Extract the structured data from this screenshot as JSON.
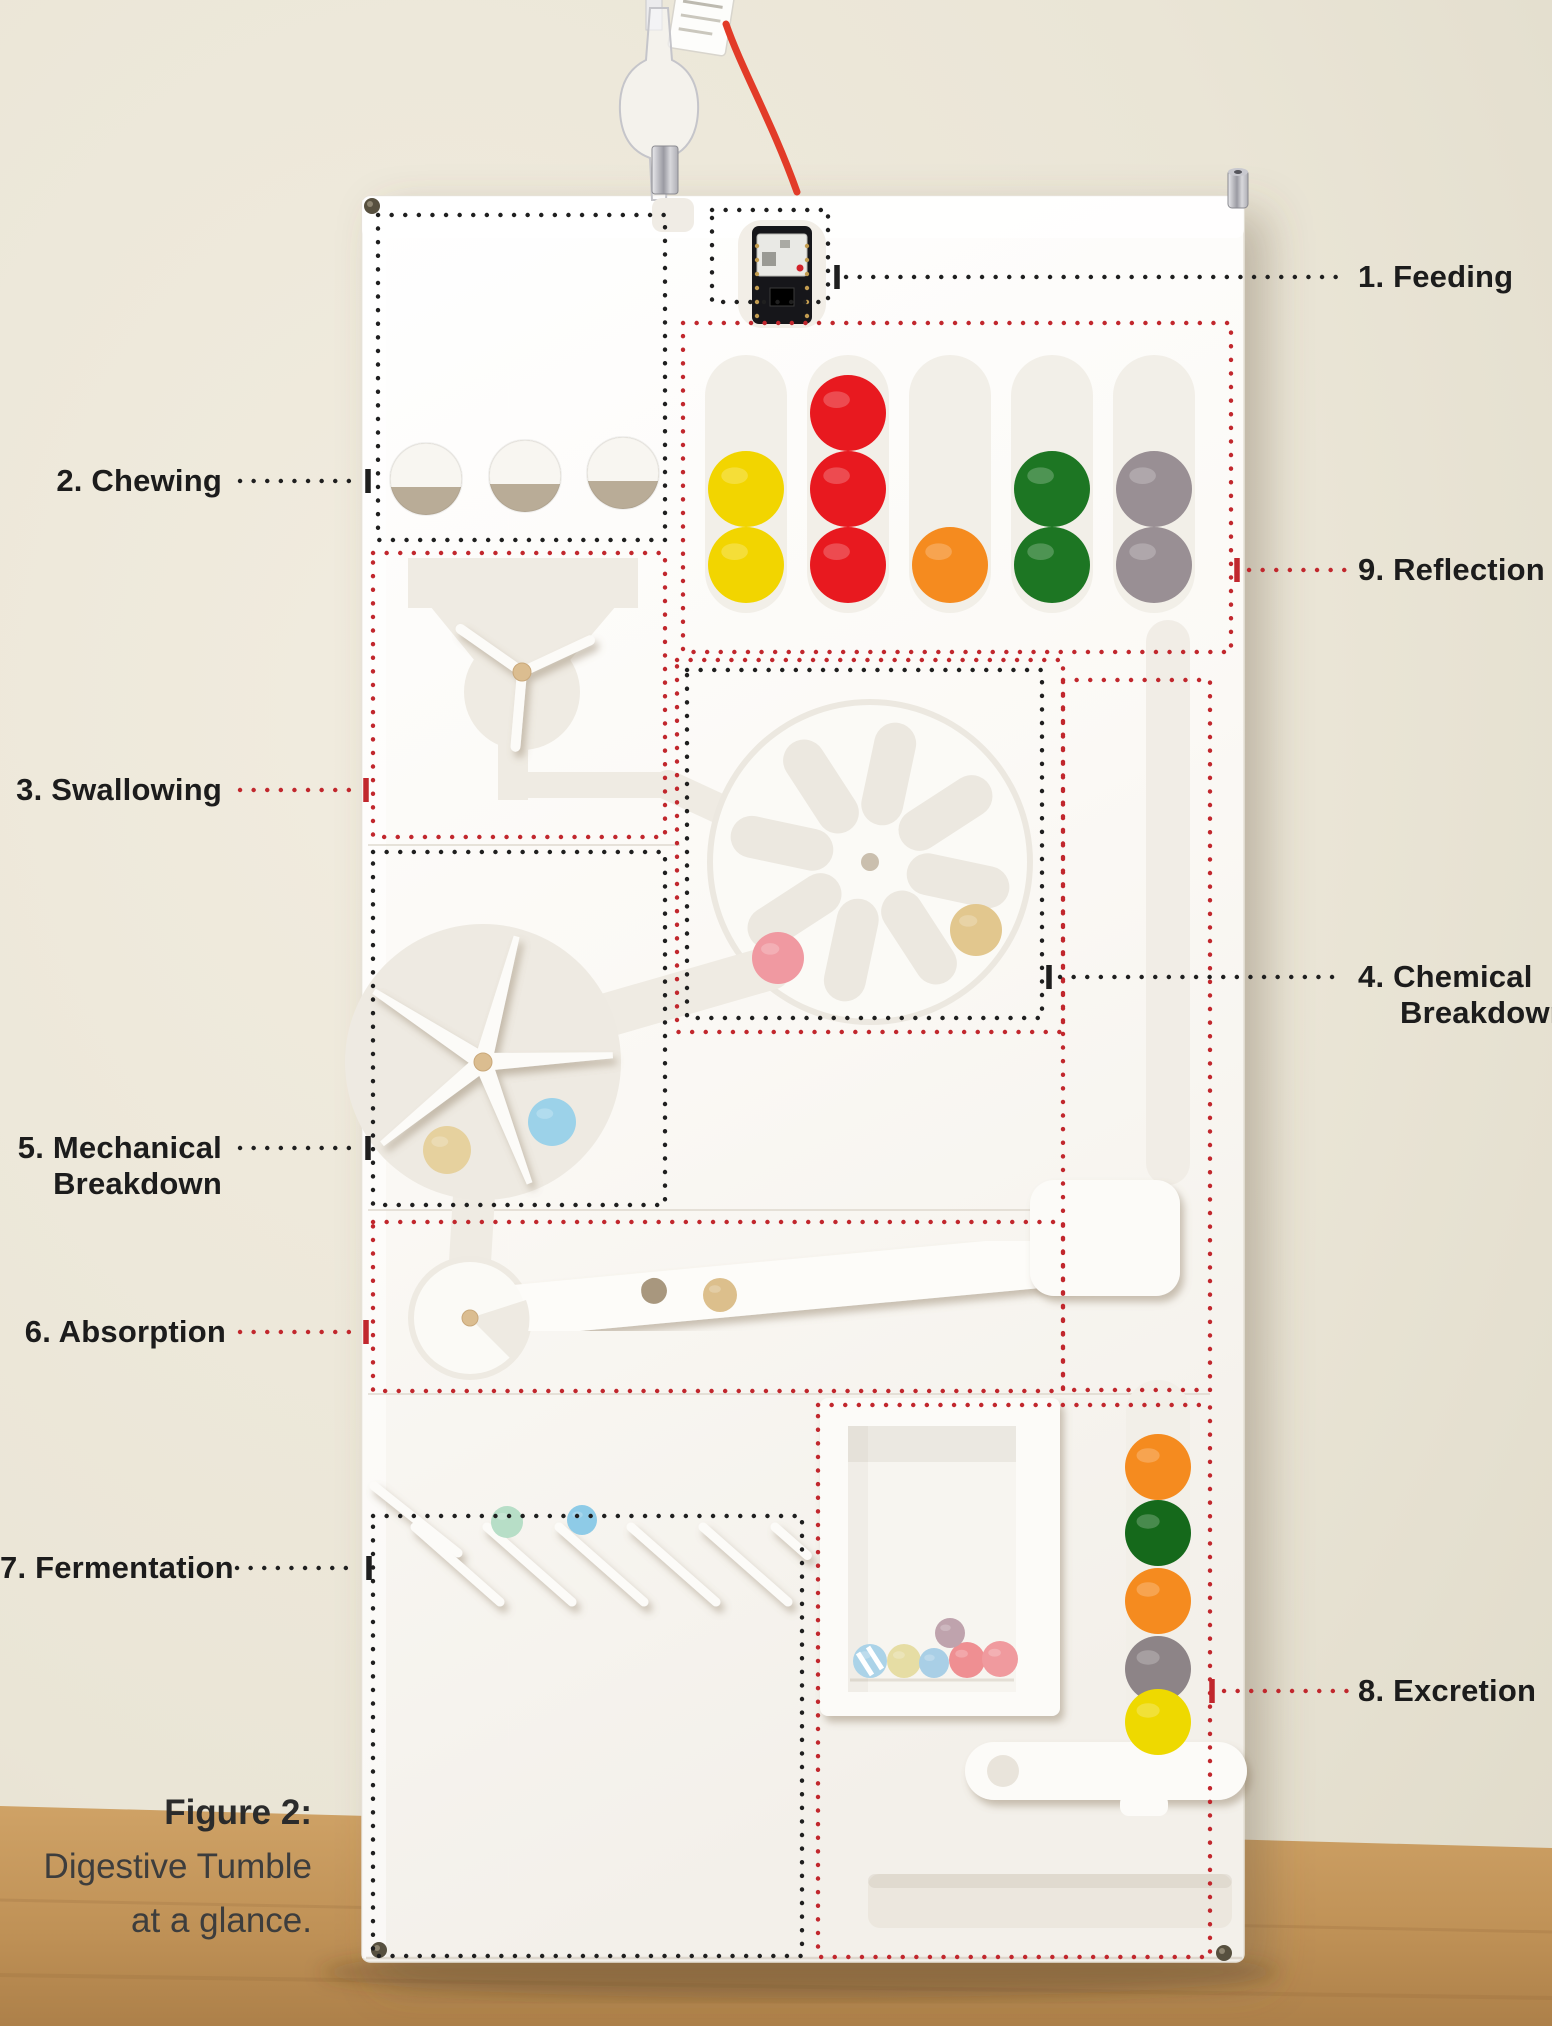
{
  "figure_caption": {
    "title": "Figure 2:",
    "line1": "Digestive Tumble",
    "line2": "at a glance."
  },
  "annotation_colors": {
    "black": "#1f1f1f",
    "red": "#c1272d"
  },
  "annotations": [
    {
      "id": "feeding",
      "label": "1. Feeding",
      "color": "black",
      "box": {
        "x": 712,
        "y": 210,
        "w": 116,
        "h": 92
      },
      "leader": {
        "x1": 846,
        "x2": 1340,
        "y": 277
      },
      "tick": {
        "x": 837,
        "y": 277
      }
    },
    {
      "id": "chewing",
      "label": "2. Chewing",
      "color": "black",
      "box": {
        "x": 378,
        "y": 215,
        "w": 287,
        "h": 325
      },
      "leader": {
        "x1": 240,
        "x2": 358,
        "y": 481
      },
      "tick": {
        "x": 368,
        "y": 481
      }
    },
    {
      "id": "swallowing",
      "label": "3. Swallowing",
      "color": "red",
      "box": {
        "x": 373,
        "y": 553,
        "w": 292,
        "h": 284
      },
      "leader": {
        "x1": 240,
        "x2": 356,
        "y": 790
      },
      "tick": {
        "x": 366,
        "y": 790
      }
    },
    {
      "id": "chemical-breakdown",
      "label": "4. Chemical Breakdown",
      "lines": [
        "4. Chemical",
        "Breakdown"
      ],
      "color": "black",
      "box": {
        "x": 687,
        "y": 670,
        "w": 355,
        "h": 348
      },
      "leader": {
        "x1": 1060,
        "x2": 1345,
        "y": 977
      },
      "tick": {
        "x": 1049,
        "y": 977
      }
    },
    {
      "id": "mechanical-breakdown",
      "label": "5. Mechanical Breakdown",
      "lines": [
        "5. Mechanical",
        "Breakdown"
      ],
      "color": "black",
      "box": {
        "x": 373,
        "y": 852,
        "w": 292,
        "h": 353
      },
      "leader": {
        "x1": 240,
        "x2": 358,
        "y": 1148
      },
      "tick": {
        "x": 368,
        "y": 1148
      }
    },
    {
      "id": "absorption",
      "label": "6. Absorption",
      "color": "red",
      "box": {
        "x": 373,
        "y": 1222,
        "w": 690,
        "h": 169
      },
      "leader": {
        "x1": 240,
        "x2": 356,
        "y": 1332
      },
      "tick": {
        "x": 366,
        "y": 1332
      }
    },
    {
      "id": "fermentation",
      "label": "7. Fermentation",
      "color": "black",
      "box": {
        "x": 373,
        "y": 1516,
        "w": 429,
        "h": 440
      },
      "leader": {
        "x1": 237,
        "x2": 359,
        "y": 1568
      },
      "tick": {
        "x": 369,
        "y": 1568
      }
    },
    {
      "id": "excretion",
      "label": "8. Excretion",
      "color": "red",
      "box": {
        "x": 818,
        "y": 1405,
        "w": 392,
        "h": 552
      },
      "leader": {
        "x1": 1224,
        "x2": 1350,
        "y": 1691
      },
      "tick": {
        "x": 1212,
        "y": 1691
      }
    },
    {
      "id": "reflection",
      "label": "9. Reflection",
      "color": "red",
      "box": {
        "x": 683,
        "y": 323,
        "w": 548,
        "h": 329
      },
      "leader": {
        "x1": 1249,
        "x2": 1350,
        "y": 570
      },
      "tick": {
        "x": 1237,
        "y": 570
      }
    }
  ],
  "extra_boxes": [
    {
      "id": "chemical-outer-red",
      "color": "red",
      "x": 677,
      "y": 660,
      "w": 386,
      "h": 372
    },
    {
      "id": "right-channel-red",
      "color": "red",
      "x": 1063,
      "y": 680,
      "w": 147,
      "h": 710
    }
  ],
  "machine": {
    "ball_groups": [
      {
        "name": "reflection-column-yellow",
        "r": 38,
        "balls": [
          {
            "cx": 746,
            "cy": 489,
            "hex": "#f2d500"
          },
          {
            "cx": 746,
            "cy": 565,
            "hex": "#f2d500"
          }
        ]
      },
      {
        "name": "reflection-column-red",
        "r": 38,
        "balls": [
          {
            "cx": 848,
            "cy": 413,
            "hex": "#e8191f"
          },
          {
            "cx": 848,
            "cy": 489,
            "hex": "#e8191f"
          },
          {
            "cx": 848,
            "cy": 565,
            "hex": "#e8191f"
          }
        ]
      },
      {
        "name": "reflection-column-orange",
        "r": 38,
        "balls": [
          {
            "cx": 950,
            "cy": 565,
            "hex": "#f58b1f"
          }
        ]
      },
      {
        "name": "reflection-column-green",
        "r": 38,
        "balls": [
          {
            "cx": 1052,
            "cy": 489,
            "hex": "#1d7623"
          },
          {
            "cx": 1052,
            "cy": 565,
            "hex": "#1d7623"
          }
        ]
      },
      {
        "name": "reflection-column-gray",
        "r": 38,
        "balls": [
          {
            "cx": 1154,
            "cy": 489,
            "hex": "#998f94"
          },
          {
            "cx": 1154,
            "cy": 565,
            "hex": "#998f94"
          }
        ]
      },
      {
        "name": "chemical-wheel-balls",
        "r": 26,
        "balls": [
          {
            "cx": 778,
            "cy": 958,
            "hex": "#f099a1"
          },
          {
            "cx": 976,
            "cy": 930,
            "hex": "#e2c78e"
          }
        ]
      },
      {
        "name": "mechanical-wheel-balls",
        "r": 24,
        "balls": [
          {
            "cx": 447,
            "cy": 1150,
            "hex": "#e6d19e"
          },
          {
            "cx": 552,
            "cy": 1122,
            "hex": "#9cd2e9"
          }
        ]
      },
      {
        "name": "absorption-channel-ball",
        "r": 17,
        "balls": [
          {
            "cx": 720,
            "cy": 1295,
            "hex": "#dcbf8c"
          }
        ]
      },
      {
        "name": "fermentation-balls",
        "r": 16,
        "balls": [
          {
            "cx": 507,
            "cy": 1522,
            "hex": "#b7dec7"
          },
          {
            "cx": 582,
            "cy": 1520,
            "r": 15,
            "hex": "#8ecbe7"
          }
        ]
      },
      {
        "name": "excretion-channel-stack",
        "r": 33,
        "balls": [
          {
            "cx": 1158,
            "cy": 1467,
            "hex": "#f58b1f"
          },
          {
            "cx": 1158,
            "cy": 1533,
            "hex": "#15691b"
          },
          {
            "cx": 1158,
            "cy": 1601,
            "hex": "#f58b1f"
          },
          {
            "cx": 1158,
            "cy": 1669,
            "hex": "#8d8487"
          },
          {
            "cx": 1158,
            "cy": 1722,
            "hex": "#eed900"
          }
        ]
      },
      {
        "name": "excretion-window-balls",
        "r": 17,
        "balls": [
          {
            "cx": 870,
            "cy": 1661,
            "hex": "#abd3e8",
            "striped": true
          },
          {
            "cx": 904,
            "cy": 1661,
            "hex": "#e6dda4"
          },
          {
            "cx": 934,
            "cy": 1663,
            "r": 15,
            "hex": "#a9cfe6"
          },
          {
            "cx": 967,
            "cy": 1660,
            "r": 18,
            "hex": "#ef8f92"
          },
          {
            "cx": 1000,
            "cy": 1659,
            "r": 18,
            "hex": "#f09a9e"
          },
          {
            "cx": 950,
            "cy": 1633,
            "r": 15,
            "hex": "#bfa3ad"
          }
        ]
      }
    ]
  }
}
